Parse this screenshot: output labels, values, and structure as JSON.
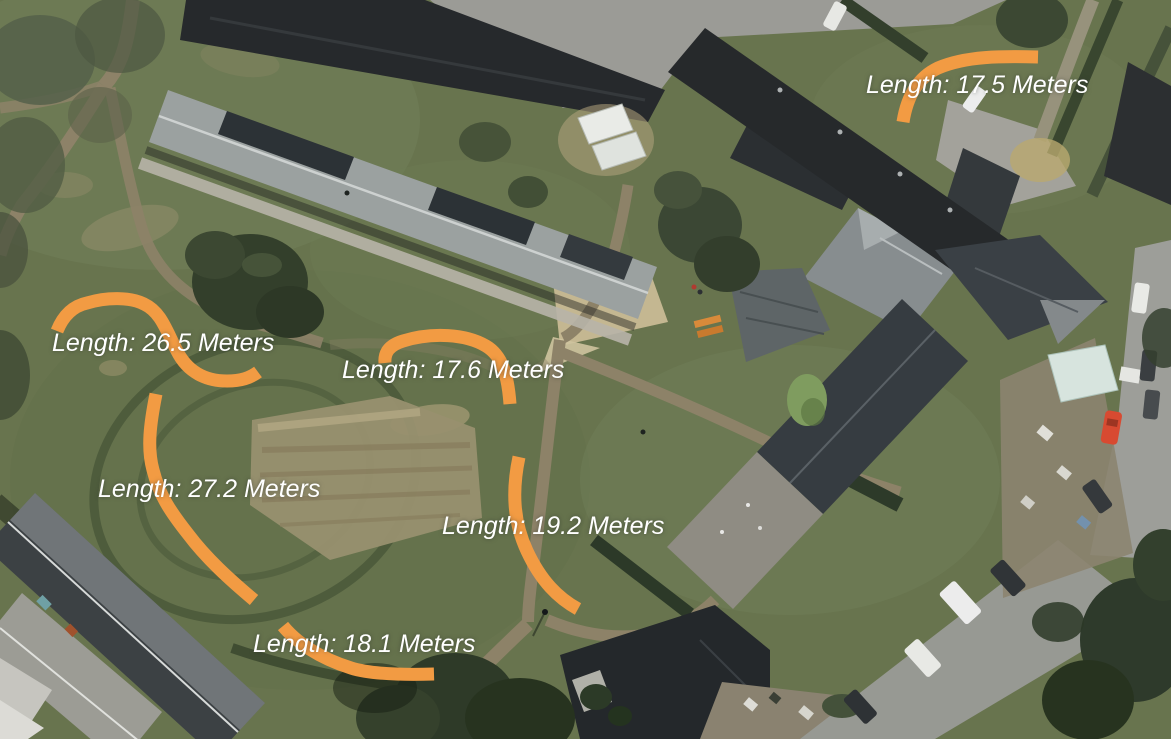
{
  "colors": {
    "annotation_orange": "#F29B43",
    "label_text": "#FFFFFF"
  },
  "unit": "Meters",
  "measurements": [
    {
      "label": "Length: 17.5 Meters",
      "value_meters": 17.5,
      "path": "M903,122 C907,97 917,78 938,68 C966,56 1002,56 1038,57"
    },
    {
      "label": "Length: 26.5 Meters",
      "value_meters": 26.5,
      "path": "M57,331 C63,316 73,306 87,303 C107,297 130,297 144,304 C161,312 166,330 177,351 C188,373 207,381 227,381 C241,381 250,378 258,372"
    },
    {
      "label": "Length: 17.6 Meters",
      "value_meters": 17.6,
      "path": "M385,363 C384,352 390,345 403,341 C432,332 466,334 486,346 C503,356 508,377 510,404"
    },
    {
      "label": "Length: 27.2 Meters",
      "value_meters": 27.2,
      "path": "M156,394 C150,424 147,448 153,470 C159,494 169,510 188,534 C206,558 229,579 254,600"
    },
    {
      "label": "Length: 19.2 Meters",
      "value_meters": 19.2,
      "path": "M519,457 C512,490 513,521 527,551 C541,581 558,598 578,609"
    },
    {
      "label": "Length: 18.1 Meters",
      "value_meters": 18.1,
      "path": "M283,626 C296,642 319,658 351,668 C370,674 401,675 434,674"
    }
  ],
  "map": {
    "type": "aerial-satellite-imagery",
    "visible_features": [
      "grass lawns",
      "residential terraced buildings",
      "footpaths",
      "roads with parked cars",
      "back gardens",
      "trees",
      "red car",
      "greenhouses",
      "allotment dirt patch"
    ]
  }
}
